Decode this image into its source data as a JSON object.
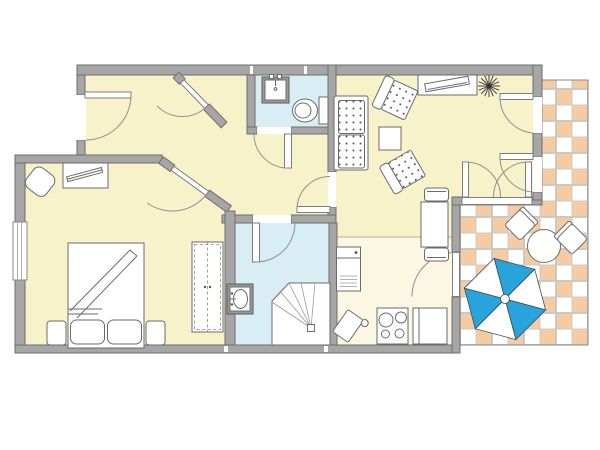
{
  "canvas": {
    "width": 600,
    "height": 450,
    "background": "#ffffff"
  },
  "colors": {
    "background": "#ffffff",
    "floor_yellow": "#f7f2c9",
    "floor_cream": "#fbf7e2",
    "floor_blue": "#d9edf4",
    "wall_fill": "#a6a6a6",
    "wall_stroke": "#6e6e6e",
    "line": "#6b6b6b",
    "fixture_gray": "#9a9a9a",
    "tile_orange": "#f5cba3",
    "tile_line": "#c9c9c9",
    "umbrella_blue": "#29a3dc"
  },
  "floor_plan": {
    "rooms": [
      {
        "id": "entry-hall",
        "floor": "floor_yellow"
      },
      {
        "id": "hallway",
        "floor": "floor_yellow"
      },
      {
        "id": "bedroom",
        "floor": "floor_yellow"
      },
      {
        "id": "wc",
        "floor": "floor_blue"
      },
      {
        "id": "bathroom",
        "floor": "floor_blue"
      },
      {
        "id": "living-room",
        "floor": "floor_yellow"
      },
      {
        "id": "kitchen",
        "floor": "floor_cream"
      },
      {
        "id": "terrace",
        "floor": "tiled-checkerboard"
      }
    ],
    "doors": [
      "entrance-door",
      "entry-hall-door",
      "bedroom-door",
      "wc-door",
      "bathroom-door",
      "living-room-door",
      "kitchen-terrace-door",
      "living-terrace-double-door",
      "terrace-french-door-upper",
      "terrace-french-door-lower"
    ],
    "windows": [
      "bedroom-window"
    ],
    "furniture": {
      "bedroom": [
        "desk",
        "desk-chair",
        "double-bed",
        "pillows",
        "nightstands",
        "wardrobe"
      ],
      "wc": [
        "hand-basin",
        "toilet"
      ],
      "bathroom": [
        "wash-basin",
        "corner-shower"
      ],
      "kitchen": [
        "refrigerator",
        "stove-4-burners",
        "counter-sink",
        "kitchen-trolley"
      ],
      "living_room": [
        "two-seat-sofa",
        "armchair",
        "armchair",
        "coffee-table",
        "sideboard-tv",
        "plant",
        "dining-table",
        "dining-chairs"
      ],
      "terrace": [
        "round-table",
        "terrace-chairs",
        "parasol"
      ]
    }
  }
}
